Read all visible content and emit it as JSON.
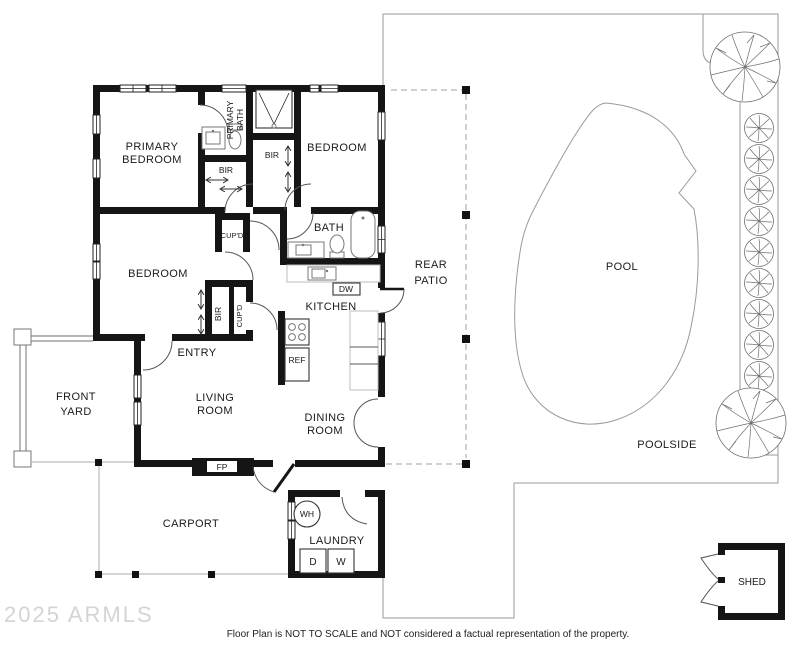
{
  "watermark": "2025 ARMLS",
  "footer": {
    "disclaimer": "Floor Plan is NOT TO SCALE and NOT considered a factual representation of the property."
  },
  "rooms": {
    "primary_bedroom": {
      "line1": "PRIMARY",
      "line2": "BEDROOM"
    },
    "primary_bath": {
      "line1": "PRIMARY",
      "line2": "BATH"
    },
    "bedroom_upper_right": "BEDROOM",
    "bedroom_left": "BEDROOM",
    "bath": "BATH",
    "kitchen": "KITCHEN",
    "entry": "ENTRY",
    "living_room": {
      "line1": "LIVING",
      "line2": "ROOM"
    },
    "dining_room": {
      "line1": "DINING",
      "line2": "ROOM"
    },
    "rear_patio": {
      "line1": "REAR",
      "line2": "PATIO"
    },
    "pool": "POOL",
    "poolside": "POOLSIDE",
    "front_yard": {
      "line1": "FRONT",
      "line2": "YARD"
    },
    "carport": "CARPORT",
    "laundry": "LAUNDRY",
    "shed": "SHED"
  },
  "closets": {
    "bir_primary": "BIR",
    "bir_bedroom": "BIR",
    "bir_hall": "BIR",
    "cupboard_upper": "CUP'D",
    "cupboard_lower": "CUP'D"
  },
  "fixtures": {
    "dishwasher": "DW",
    "refrigerator": "REF",
    "fireplace": "FP",
    "water_heater": "WH",
    "dryer": "D",
    "washer": "W"
  },
  "colors": {
    "wall": "#151515",
    "property_line": "#9a9a9a",
    "patio_dash": "#b5b5b5",
    "tree": "#6e6e6e",
    "watermark": "#d4d4d4",
    "text": "#1a1a1a"
  }
}
